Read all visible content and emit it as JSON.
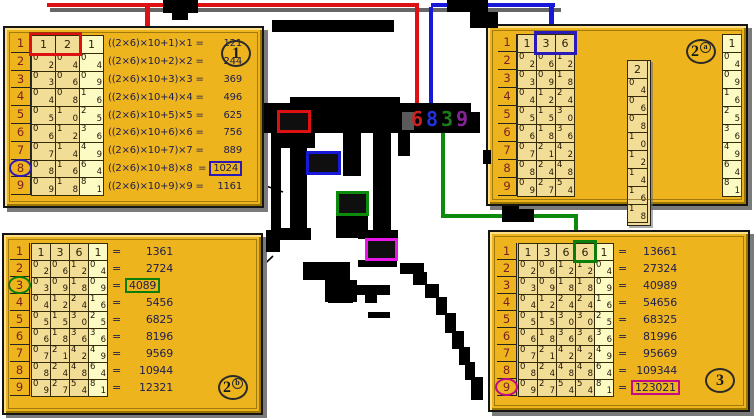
{
  "colors": {
    "panel_bg": "#edb41e",
    "cell_cream": "#f2dd96",
    "cell_light": "#fdfbc4",
    "index_digit": "#7c2020",
    "cell_digit": "#201504",
    "header_digit": "#2a1e06",
    "formula_text": "#1d1d4f",
    "result_text": "#1d1d4f",
    "red": "#dd1111",
    "blue": "#1818d8",
    "green": "#0b8a0b",
    "magenta": "#e816e8",
    "box_blue": "#2a1ab8",
    "box_green": "#0b7d0b",
    "box_magenta": "#c40a86",
    "box_red": "#dd1111",
    "root_digit_colors": [
      "#cc2222",
      "#2233dd",
      "#1d7a1d",
      "#882299"
    ],
    "grey": "#5a5a5a",
    "shadow_grey": "#666666",
    "ink": "#000000"
  },
  "root_digits": [
    "6",
    "8",
    "3",
    "9"
  ],
  "eq": "=",
  "panels": [
    {
      "id": "p1",
      "badge": {
        "main": "1",
        "sub": ""
      },
      "index": [
        "1",
        "2",
        "3",
        "4",
        "5",
        "6",
        "7",
        "8",
        "9"
      ],
      "header": [
        "1",
        "2",
        "1"
      ],
      "light_col": 2,
      "header_box": {
        "from": 0,
        "to": 1,
        "color": "red"
      },
      "rows": [
        [
          "0/2",
          "0/4",
          "0/4"
        ],
        [
          "0/3",
          "0/6",
          "0/9"
        ],
        [
          "0/4",
          "0/8",
          "1/6"
        ],
        [
          "0/5",
          "1/0",
          "2/5"
        ],
        [
          "0/6",
          "1/2",
          "3/6"
        ],
        [
          "0/7",
          "1/4",
          "4/9"
        ],
        [
          "0/8",
          "1/6",
          "6/4"
        ],
        [
          "0/9",
          "1/8",
          "8/1"
        ]
      ],
      "formulas": [
        {
          "expr": "((2×6)×10+1)×1",
          "result": "121"
        },
        {
          "expr": "((2×6)×10+2)×2",
          "result": "244"
        },
        {
          "expr": "((2×6)×10+3)×3",
          "result": "369"
        },
        {
          "expr": "((2×6)×10+4)×4",
          "result": "496"
        },
        {
          "expr": "((2×6)×10+5)×5",
          "result": "625"
        },
        {
          "expr": "((2×6)×10+6)×6",
          "result": "756"
        },
        {
          "expr": "((2×6)×10+7)×7",
          "result": "889"
        },
        {
          "expr": "((2×6)×10+8)×8",
          "result": "1024"
        },
        {
          "expr": "((2×6)×10+9)×9",
          "result": "1161"
        }
      ],
      "highlight": {
        "row": 8,
        "color": "blue"
      }
    },
    {
      "id": "p2a",
      "badge": {
        "main": "2",
        "sub": "a"
      },
      "index": [
        "1",
        "2",
        "3",
        "4",
        "5",
        "6",
        "7",
        "8",
        "9"
      ],
      "header": [
        "1",
        "3",
        "6"
      ],
      "light_col": -1,
      "header_box": {
        "from": 1,
        "to": 2,
        "color": "blue"
      },
      "rows": [
        [
          "0/2",
          "0/6",
          "1/2"
        ],
        [
          "0/3",
          "0/9",
          "1/8"
        ],
        [
          "0/4",
          "1/2",
          "2/4"
        ],
        [
          "0/5",
          "1/5",
          "3/0"
        ],
        [
          "0/6",
          "1/8",
          "3/6"
        ],
        [
          "0/7",
          "2/1",
          "4/2"
        ],
        [
          "0/8",
          "2/4",
          "4/8"
        ],
        [
          "0/9",
          "2/7",
          "5/4"
        ]
      ],
      "rod": {
        "header": "2",
        "cells": [
          "0/4",
          "0/6",
          "0/8",
          "1/0",
          "1/2",
          "1/4",
          "1/6",
          "1/8"
        ]
      },
      "squares": {
        "header": "1",
        "cells": [
          "0/4",
          "0/9",
          "1/6",
          "2/5",
          "3/6",
          "4/9",
          "6/4",
          "8/1"
        ]
      }
    },
    {
      "id": "p2b",
      "badge": {
        "main": "2",
        "sub": "b"
      },
      "index": [
        "1",
        "2",
        "3",
        "4",
        "5",
        "6",
        "7",
        "8",
        "9"
      ],
      "header": [
        "1",
        "3",
        "6",
        "1"
      ],
      "light_col": 3,
      "rows": [
        [
          "0/2",
          "0/6",
          "1/2",
          "0/4"
        ],
        [
          "0/3",
          "0/9",
          "1/8",
          "0/9"
        ],
        [
          "0/4",
          "1/2",
          "2/4",
          "1/6"
        ],
        [
          "0/5",
          "1/5",
          "3/0",
          "2/5"
        ],
        [
          "0/6",
          "1/8",
          "3/6",
          "3/6"
        ],
        [
          "0/7",
          "2/1",
          "4/2",
          "4/9"
        ],
        [
          "0/8",
          "2/4",
          "4/8",
          "6/4"
        ],
        [
          "0/9",
          "2/7",
          "5/4",
          "8/1"
        ]
      ],
      "results": [
        "1361",
        "2724",
        "4089",
        "5456",
        "6825",
        "8196",
        "9569",
        "10944",
        "12321"
      ],
      "highlight": {
        "row": 3,
        "color": "green"
      }
    },
    {
      "id": "p3",
      "badge": {
        "main": "3",
        "sub": ""
      },
      "index": [
        "1",
        "2",
        "3",
        "4",
        "5",
        "6",
        "7",
        "8",
        "9"
      ],
      "header": [
        "1",
        "3",
        "6",
        "6",
        "1"
      ],
      "light_col": 4,
      "header_box": {
        "from": 3,
        "to": 3,
        "color": "green"
      },
      "rows": [
        [
          "0/2",
          "0/6",
          "1/2",
          "1/2",
          "0/4"
        ],
        [
          "0/3",
          "0/9",
          "1/8",
          "1/8",
          "0/9"
        ],
        [
          "0/4",
          "1/2",
          "2/4",
          "2/4",
          "1/6"
        ],
        [
          "0/5",
          "1/5",
          "3/0",
          "3/0",
          "2/5"
        ],
        [
          "0/6",
          "1/8",
          "3/6",
          "3/6",
          "3/6"
        ],
        [
          "0/7",
          "2/1",
          "4/2",
          "4/2",
          "4/9"
        ],
        [
          "0/8",
          "2/4",
          "4/8",
          "4/8",
          "6/4"
        ],
        [
          "0/9",
          "2/7",
          "5/4",
          "5/4",
          "8/1"
        ]
      ],
      "results": [
        "13661",
        "27324",
        "40989",
        "54656",
        "68325",
        "81996",
        "95669",
        "109344",
        "123021"
      ],
      "highlight": {
        "row": 9,
        "color": "magenta"
      }
    }
  ],
  "center": {
    "boxes": [
      {
        "x": 277,
        "y": 110,
        "w": 34,
        "h": 23,
        "color": "red"
      },
      {
        "x": 306,
        "y": 151,
        "w": 35,
        "h": 24,
        "color": "blue"
      },
      {
        "x": 336,
        "y": 191,
        "w": 33,
        "h": 25,
        "color": "green"
      },
      {
        "x": 365,
        "y": 238,
        "w": 33,
        "h": 23,
        "color": "magenta"
      }
    ],
    "marks": [
      [
        163,
        0,
        35,
        13
      ],
      [
        172,
        13,
        16,
        7
      ],
      [
        447,
        0,
        41,
        12
      ],
      [
        470,
        12,
        28,
        16
      ],
      [
        272,
        20,
        122,
        12
      ],
      [
        290,
        97,
        110,
        8
      ],
      [
        264,
        103,
        207,
        30
      ],
      [
        468,
        112,
        12,
        21
      ],
      [
        271,
        133,
        44,
        15
      ],
      [
        271,
        148,
        10,
        92
      ],
      [
        290,
        133,
        17,
        107
      ],
      [
        343,
        128,
        18,
        48
      ],
      [
        373,
        128,
        18,
        112
      ],
      [
        398,
        133,
        12,
        23
      ],
      [
        336,
        216,
        32,
        22
      ],
      [
        280,
        228,
        31,
        12
      ],
      [
        266,
        230,
        14,
        22
      ],
      [
        358,
        230,
        40,
        9
      ],
      [
        358,
        260,
        39,
        7
      ],
      [
        303,
        262,
        47,
        18
      ],
      [
        325,
        280,
        32,
        22
      ],
      [
        328,
        285,
        62,
        10
      ],
      [
        328,
        295,
        25,
        8
      ],
      [
        365,
        295,
        12,
        8
      ],
      [
        368,
        312,
        22,
        6
      ],
      [
        400,
        263,
        24,
        11
      ],
      [
        413,
        272,
        14,
        13
      ],
      [
        425,
        284,
        14,
        14
      ],
      [
        436,
        297,
        11,
        18
      ],
      [
        445,
        313,
        11,
        20
      ],
      [
        452,
        331,
        12,
        18
      ],
      [
        459,
        347,
        11,
        18
      ],
      [
        465,
        362,
        10,
        18
      ],
      [
        471,
        377,
        12,
        23
      ],
      [
        502,
        206,
        17,
        16
      ],
      [
        519,
        209,
        15,
        13
      ],
      [
        483,
        150,
        8,
        14
      ]
    ],
    "grey_marks": [
      [
        402,
        112,
        12,
        18
      ]
    ]
  }
}
